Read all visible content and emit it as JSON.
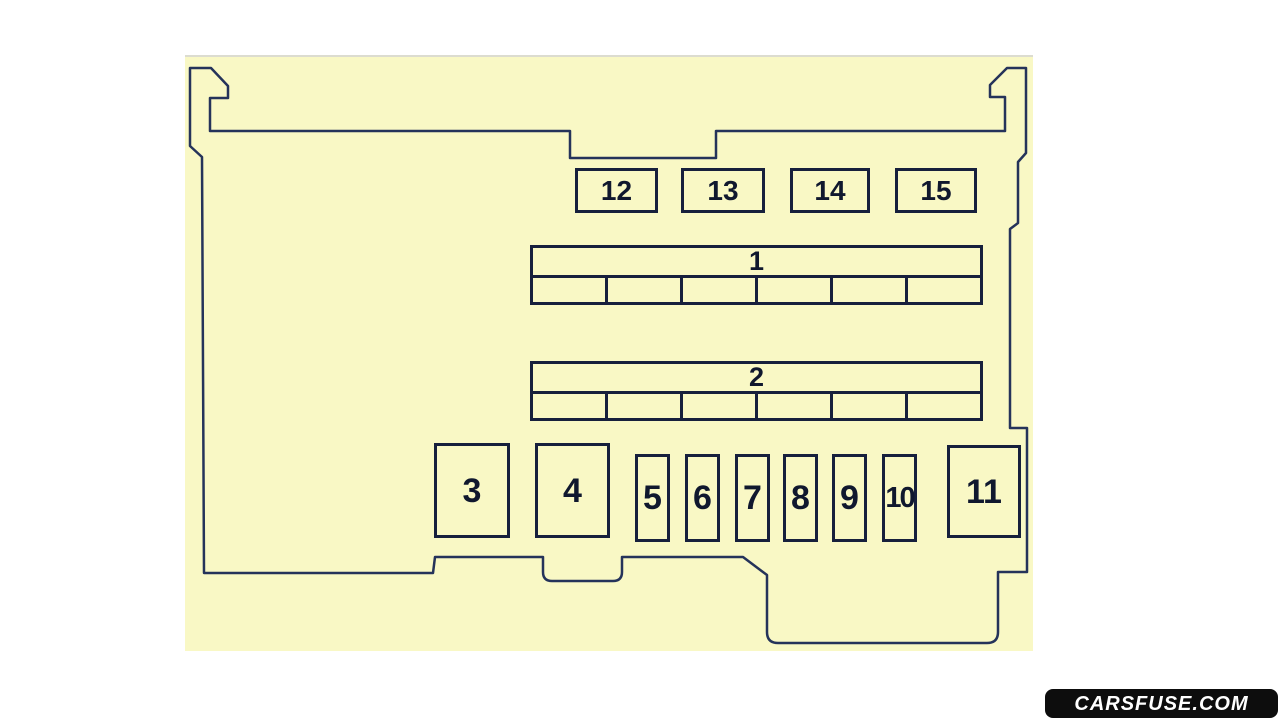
{
  "fuse_boxes": {
    "top_row": [
      {
        "label": "12"
      },
      {
        "label": "13"
      },
      {
        "label": "14"
      },
      {
        "label": "15"
      }
    ],
    "relay_blocks": [
      {
        "label": "1",
        "cell_count": 6
      },
      {
        "label": "2",
        "cell_count": 6
      }
    ],
    "bottom_row": [
      {
        "label": "3"
      },
      {
        "label": "4"
      },
      {
        "label": "5"
      },
      {
        "label": "6"
      },
      {
        "label": "7"
      },
      {
        "label": "8"
      },
      {
        "label": "9"
      },
      {
        "label": "10"
      },
      {
        "label": "11"
      }
    ]
  },
  "watermark": {
    "text": "CARSFUSE.COM"
  },
  "colors": {
    "canvas_fill": "#f9f8c5",
    "outline_stroke": "#25335a",
    "box_border": "#17203c",
    "label_text": "#10182e",
    "watermark_bg": "#0d0d0d",
    "watermark_text": "#ffffff"
  }
}
